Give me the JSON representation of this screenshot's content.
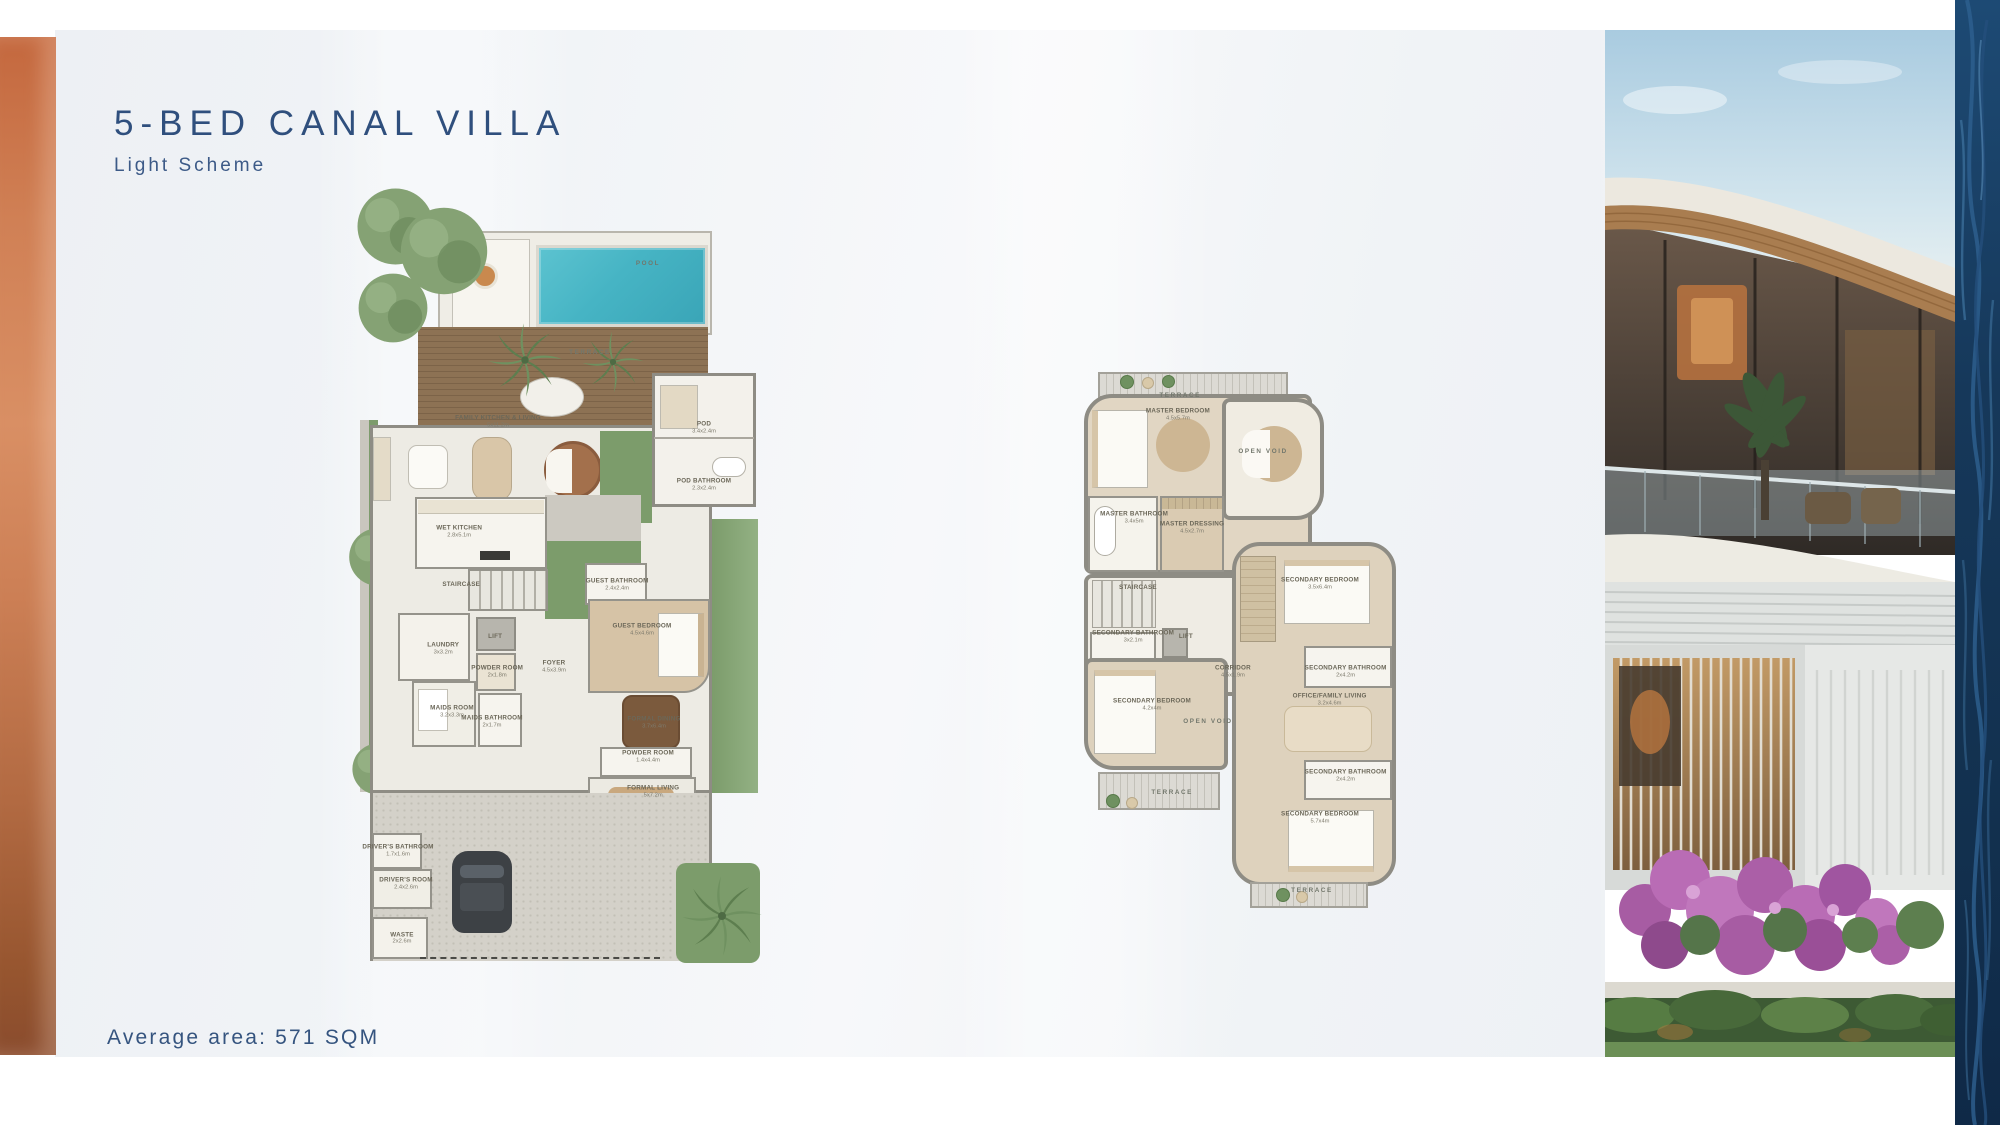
{
  "header": {
    "title": "5-BED CANAL VILLA",
    "subtitle": "Light Scheme"
  },
  "footer": {
    "average_area": "Average area: 571 SQM"
  },
  "colors": {
    "accent_copper": "#c4683e",
    "title_navy": "#2f4f7d",
    "pool_teal": "#46b4c4",
    "deck_wood": "#8d7254",
    "landscape_green": "#7c9c6b",
    "plan_wall_grey": "#8e8c84",
    "water_navy": "#14304e"
  },
  "ground_floor": {
    "rooms": [
      {
        "label": "POOL",
        "dim": "",
        "x": 72,
        "y": 10,
        "spaced": true
      },
      {
        "label": "TERRACE",
        "dim": "",
        "x": 57.5,
        "y": 21.4,
        "spaced": true
      },
      {
        "label": "FAMILY KITCHEN & LIVING",
        "dim": "5x11.2m",
        "x": 34.5,
        "y": 30.2
      },
      {
        "label": "POD",
        "dim": "3.4x2.4m",
        "x": 86,
        "y": 31
      },
      {
        "label": "POD BATHROOM",
        "dim": "2.3x2.4m",
        "x": 86,
        "y": 38.2
      },
      {
        "label": "WET KITCHEN",
        "dim": "2.8x5.1m",
        "x": 24.8,
        "y": 44.2
      },
      {
        "label": "STAIRCASE",
        "dim": "",
        "x": 25.3,
        "y": 51
      },
      {
        "label": "GUEST BATHROOM",
        "dim": "2.4x2.4m",
        "x": 64.3,
        "y": 51
      },
      {
        "label": "GUEST BEDROOM",
        "dim": "4.5x4.6m",
        "x": 70.5,
        "y": 56.7
      },
      {
        "label": "FOYER",
        "dim": "4.5x3.9m",
        "x": 48.5,
        "y": 61.4
      },
      {
        "label": "LAUNDRY",
        "dim": "3x3.2m",
        "x": 20.8,
        "y": 59.1
      },
      {
        "label": "LIFT",
        "dim": "",
        "x": 33.8,
        "y": 57.6
      },
      {
        "label": "POWDER ROOM",
        "dim": "2x1.8m",
        "x": 34.3,
        "y": 62
      },
      {
        "label": "MAIDS ROOM",
        "dim": "3.2x3.3m",
        "x": 23,
        "y": 67.1
      },
      {
        "label": "MAIDS BATHROOM",
        "dim": "2x1.7m",
        "x": 33,
        "y": 68.4
      },
      {
        "label": "FORMAL DINING",
        "dim": "3.7x6.4m",
        "x": 73.5,
        "y": 68.5
      },
      {
        "label": "POWDER ROOM",
        "dim": "1.4x4.4m",
        "x": 72,
        "y": 72.9
      },
      {
        "label": "FORMAL LIVING",
        "dim": "5x7.2m",
        "x": 73.3,
        "y": 77.3
      },
      {
        "label": "DRIVER'S BATHROOM",
        "dim": "1.7x1.6m",
        "x": 9.5,
        "y": 84.8
      },
      {
        "label": "DRIVER'S ROOM",
        "dim": "2.4x2.6m",
        "x": 11.5,
        "y": 89
      },
      {
        "label": "WASTE",
        "dim": "2x2.6m",
        "x": 10.5,
        "y": 96
      }
    ]
  },
  "first_floor": {
    "rooms": [
      {
        "label": "TERRACE",
        "dim": "",
        "x": 31.3,
        "y": 4.8,
        "spaced": true
      },
      {
        "label": "MASTER BEDROOM",
        "dim": "4.5x5.7m",
        "x": 30.6,
        "y": 8.3
      },
      {
        "label": "OPEN VOID",
        "dim": "",
        "x": 57.2,
        "y": 15.2,
        "spaced": true
      },
      {
        "label": "MASTER BATHROOM",
        "dim": "3.4x5m",
        "x": 16.9,
        "y": 27.4
      },
      {
        "label": "MASTER DRESSING",
        "dim": "4.5x2.7m",
        "x": 35,
        "y": 29.3
      },
      {
        "label": "STAIRCASE",
        "dim": "",
        "x": 18.1,
        "y": 40.4
      },
      {
        "label": "SECONDARY BEDROOM",
        "dim": "3.5x6.4m",
        "x": 75,
        "y": 39.6
      },
      {
        "label": "SECONDARY BATHROOM",
        "dim": "3x2.1m",
        "x": 16.6,
        "y": 49.4
      },
      {
        "label": "LIFT",
        "dim": "",
        "x": 33.1,
        "y": 49.4
      },
      {
        "label": "CORRIDOR",
        "dim": "4.5x1.9m",
        "x": 47.8,
        "y": 55.9
      },
      {
        "label": "SECONDARY BATHROOM",
        "dim": "2x4.2m",
        "x": 83,
        "y": 55.9
      },
      {
        "label": "SECONDARY BEDROOM",
        "dim": "4.2x4m",
        "x": 22.5,
        "y": 62
      },
      {
        "label": "OPEN VOID",
        "dim": "",
        "x": 40,
        "y": 65.2,
        "spaced": true
      },
      {
        "label": "OFFICE/FAMILY LIVING",
        "dim": "3.2x4.6m",
        "x": 78,
        "y": 61.1
      },
      {
        "label": "SECONDARY BATHROOM",
        "dim": "2x4.2m",
        "x": 83,
        "y": 75.2
      },
      {
        "label": "TERRACE",
        "dim": "",
        "x": 28.8,
        "y": 78.3,
        "spaced": true
      },
      {
        "label": "SECONDARY BEDROOM",
        "dim": "5.7x4m",
        "x": 75,
        "y": 83
      },
      {
        "label": "TERRACE",
        "dim": "",
        "x": 72.5,
        "y": 96.5,
        "spaced": true
      }
    ]
  }
}
